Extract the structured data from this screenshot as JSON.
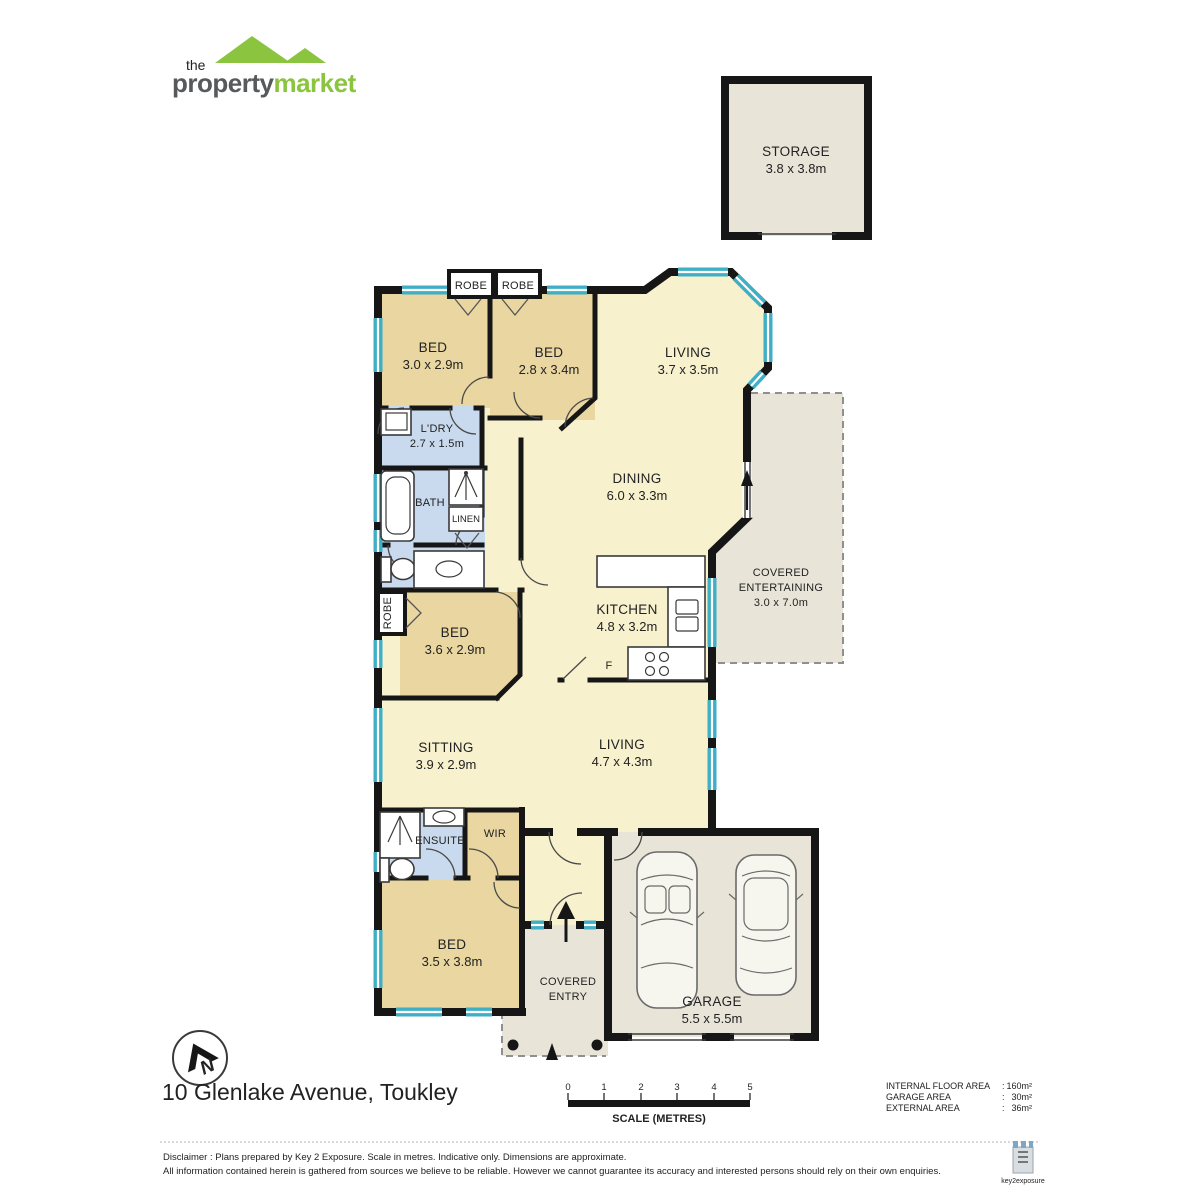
{
  "brand": {
    "the": "the",
    "property": "property",
    "market": "market"
  },
  "address": "10 Glenlake Avenue, Toukley",
  "north_label": "N",
  "rooms": {
    "storage": {
      "name": "STORAGE",
      "dims": "3.8 x 3.8m"
    },
    "robe_a": "ROBE",
    "robe_b": "ROBE",
    "robe_side": "ROBE",
    "bed1": {
      "name": "BED",
      "dims": "3.0 x 2.9m"
    },
    "bed2": {
      "name": "BED",
      "dims": "2.8 x 3.4m"
    },
    "living1": {
      "name": "LIVING",
      "dims": "3.7 x 3.5m"
    },
    "ldry": {
      "name": "L'DRY",
      "dims": "2.7 x 1.5m"
    },
    "bath": {
      "name": "BATH"
    },
    "linen": {
      "name": "LINEN"
    },
    "dining": {
      "name": "DINING",
      "dims": "6.0 x 3.3m"
    },
    "kitchen": {
      "name": "KITCHEN",
      "dims": "4.8 x 3.2m"
    },
    "fridge": "F",
    "covered_entertaining": {
      "name1": "COVERED",
      "name2": "ENTERTAINING",
      "dims": "3.0 x 7.0m"
    },
    "bed3": {
      "name": "BED",
      "dims": "3.6 x 2.9m"
    },
    "sitting": {
      "name": "SITTING",
      "dims": "3.9 x 2.9m"
    },
    "living2": {
      "name": "LIVING",
      "dims": "4.7 x 4.3m"
    },
    "ensuite": {
      "name": "ENSUITE"
    },
    "wir": {
      "name": "WIR"
    },
    "bed4": {
      "name": "BED",
      "dims": "3.5 x 3.8m"
    },
    "covered_entry": {
      "name1": "COVERED",
      "name2": "ENTRY"
    },
    "garage": {
      "name": "GARAGE",
      "dims": "5.5 x 5.5m"
    }
  },
  "scale_bar": {
    "ticks": [
      "0",
      "1",
      "2",
      "3",
      "4",
      "5"
    ],
    "label": "SCALE (METRES)"
  },
  "areas": [
    {
      "label": "INTERNAL FLOOR AREA",
      "sep": ":",
      "value": "160m²"
    },
    {
      "label": "GARAGE AREA",
      "sep": ":",
      "value": "30m²"
    },
    {
      "label": "EXTERNAL AREA",
      "sep": ":",
      "value": "36m²"
    }
  ],
  "disclaimer": {
    "line1": "Disclaimer :  Plans prepared by Key 2 Exposure. Scale in metres. Indicative only. Dimensions are approximate.",
    "line2": "All information contained herein is gathered from sources we believe to be reliable. However we cannot guarantee its accuracy and interested persons should rely on their own enquiries.",
    "footer_brand": "key2exposure"
  }
}
